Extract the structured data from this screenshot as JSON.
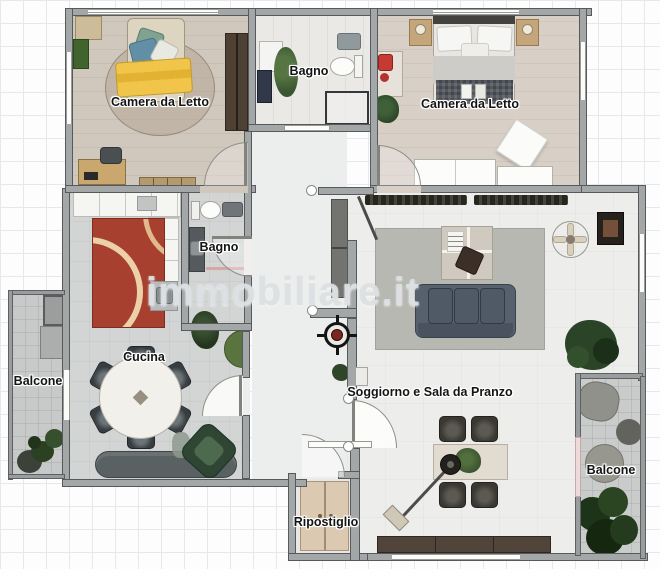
{
  "plan": {
    "watermark": "immobiliare.it",
    "labels": {
      "bedroom_left": "Camera da Letto",
      "bedroom_right": "Camera da Letto",
      "bathroom_top": "Bagno",
      "bathroom_mid": "Bagno",
      "kitchen": "Cucina",
      "balcony_left": "Balcone",
      "balcony_right": "Balcone",
      "living": "Soggiorno e Sala da Pranzo",
      "storage": "Ripostiglio"
    },
    "colors": {
      "wall": "#a4a7a8",
      "wall_edge": "#565a5c",
      "floor_bedroom_left": "#d0c7bd",
      "floor_bedroom_right": "#d8cfc7",
      "floor_bath": "#eae9e5",
      "floor_kitchen": "#d3d5d5",
      "floor_living": "#edeeec",
      "floor_balcony": "#c7cac9",
      "rug_red": "#a8402f",
      "rug_arcs": "#ecd0a8",
      "rug_gray": "#b8b8b2",
      "blanket_yellow": "#f0c54a",
      "sofa": "#57616d",
      "sideboard_wood": "#51443a",
      "plant_green": "#2b4427",
      "compass_red": "#7c2622",
      "grid": "#e3e9ec"
    }
  }
}
